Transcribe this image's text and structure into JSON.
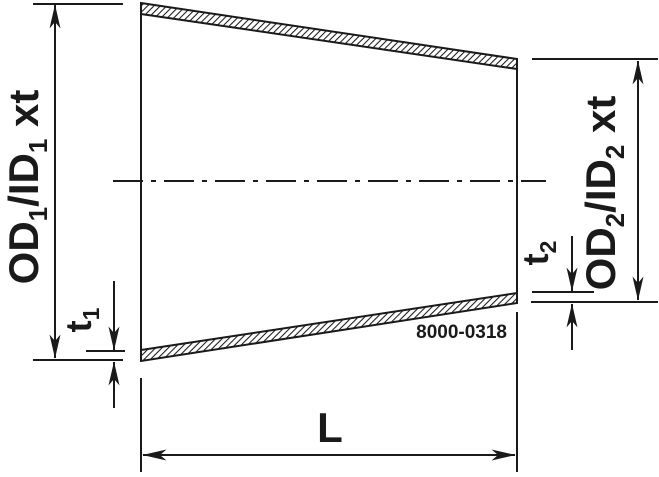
{
  "colors": {
    "line": "#1a1a1a",
    "background": "#ffffff"
  },
  "labels": {
    "od1": {
      "p1": "OD",
      "s1": "1",
      "p2": "/ID",
      "s2": "1",
      "p3": " xt"
    },
    "od2": {
      "p1": "OD",
      "s1": "2",
      "p2": "/ID",
      "s2": "2",
      "p3": " xt"
    },
    "t1": {
      "p": "t",
      "s": "1"
    },
    "t2": {
      "p": "t",
      "s": "2"
    },
    "length": "L",
    "part_number": "8000-0318"
  }
}
